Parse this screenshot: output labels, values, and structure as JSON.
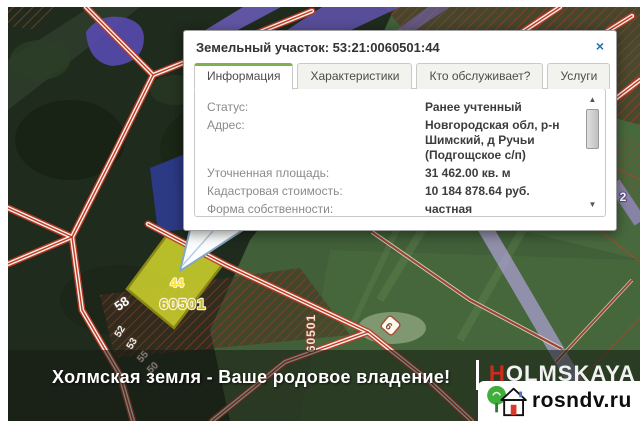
{
  "popup": {
    "title": "Земельный участок: 53:21:0060501:44",
    "tabs": [
      {
        "label": "Информация",
        "active": true
      },
      {
        "label": "Характеристики",
        "active": false
      },
      {
        "label": "Кто обслуживает?",
        "active": false
      },
      {
        "label": "Услуги",
        "active": false
      }
    ],
    "rows": [
      {
        "label": "Статус:",
        "value": "Ранее учтенный"
      },
      {
        "label": "Адрес:",
        "value": "Новгородская обл, р-н Шимский, д Ручьи (Подгощское с/п)"
      },
      {
        "label": "Уточненная площадь:",
        "value": "31 462.00 кв. м"
      },
      {
        "label": "Кадастровая стоимость:",
        "value": "10 184 878.64 руб."
      },
      {
        "label": "Форма собственности:",
        "value": "частная"
      }
    ]
  },
  "icons": {
    "close": "×",
    "scroll_up": "▲",
    "scroll_down": "▼"
  },
  "map": {
    "labels": {
      "parcel_number": "44",
      "quarter_number": "60501",
      "quarter_number_vertical": "60501",
      "parcel_58": "58",
      "parcel_52": "52",
      "parcel_53": "53",
      "parcel_55": "55",
      "parcel_50": "50",
      "parcel_6": "6",
      "road_2": "2"
    }
  },
  "banner": {
    "slogan": "Холмская земля - Ваше родовое владение!",
    "brand_first_letter": "H",
    "brand_rest": "OLMSKAYA"
  },
  "watermark": {
    "site": "rosndv.ru"
  },
  "colors": {
    "accent_green": "#7fb24b",
    "road_red": "#c03a26",
    "selected_parcel_yellow": "#c9cd2c",
    "purple_road": "#b2a2da",
    "close_blue": "#2273ad"
  }
}
